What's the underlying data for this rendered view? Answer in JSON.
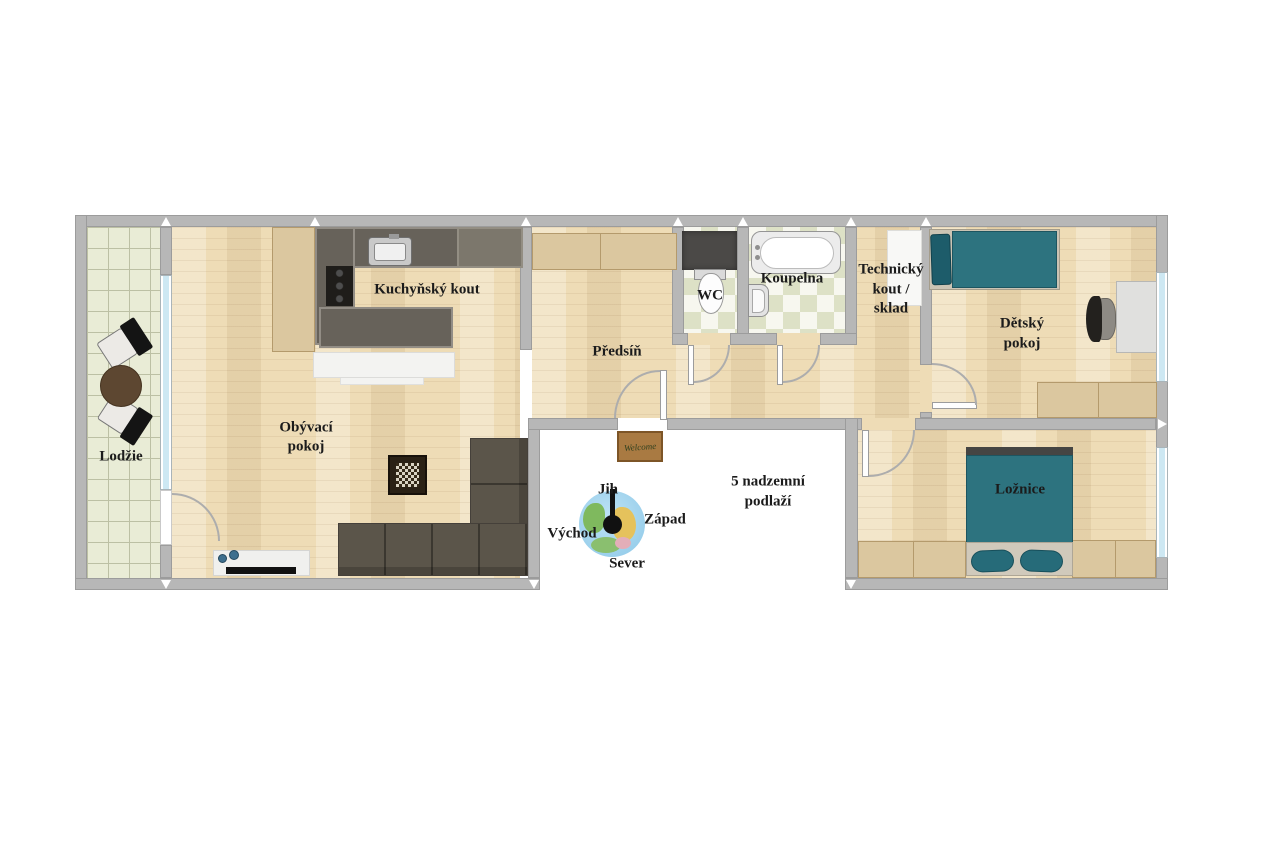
{
  "labels": {
    "loggia": "Lodžie",
    "living_1": "Obývací",
    "living_2": "pokoj",
    "kitchen": "Kuchyňský kout",
    "hall": "Předsíň",
    "wc": "WC",
    "bathroom": "Koupelna",
    "tech_1": "Technický",
    "tech_2": "kout /",
    "tech_3": "sklad",
    "kids_1": "Dětský",
    "kids_2": "pokoj",
    "bedroom": "Ložnice",
    "floor_1": "5 nadzemní",
    "floor_2": "podlaží",
    "doormat": "Welcome"
  },
  "compass": {
    "south": "Jih",
    "west": "Západ",
    "east": "Východ",
    "north": "Sever"
  },
  "colors": {
    "wall": "#b7b7b7",
    "wood_floor": "#eedcb6",
    "loggia_tile": "#e9ecd6",
    "teal_furniture": "#2d7480",
    "kitchen_counter": "#67625a",
    "sofa": "#5b554a",
    "wardrobe": "#dbc79f",
    "window_glass": "#cde8f3",
    "doormat": "#a97a42"
  }
}
